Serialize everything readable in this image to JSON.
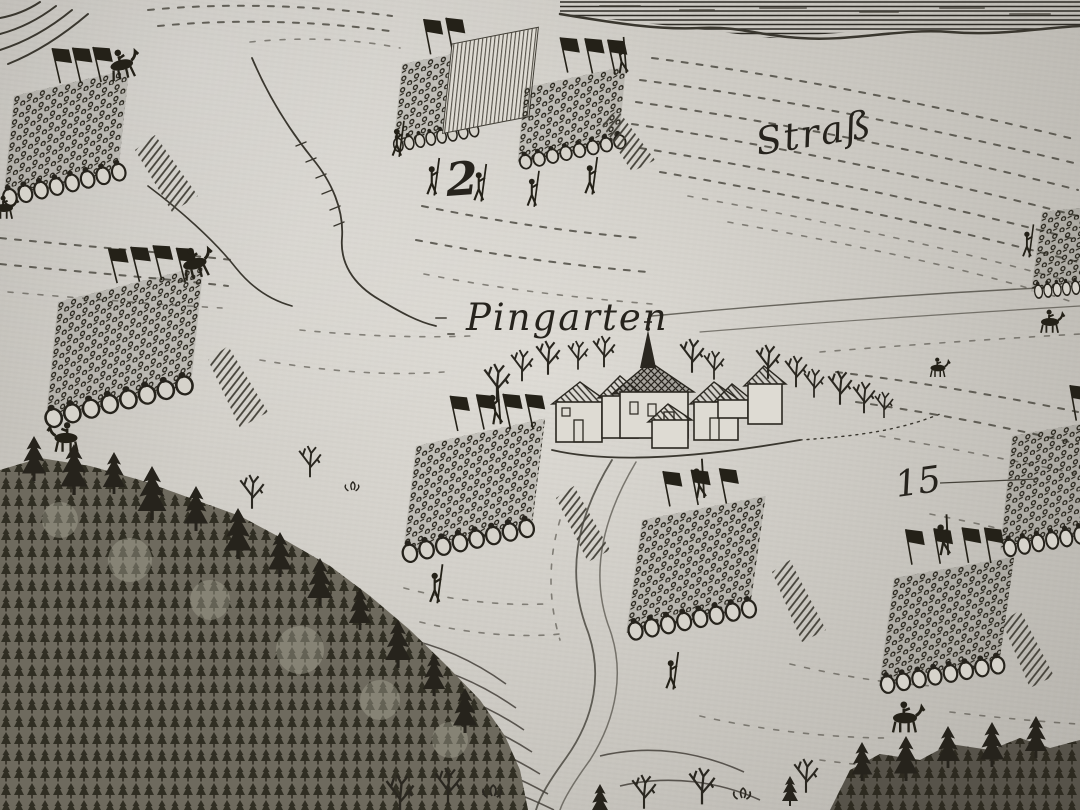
{
  "map": {
    "kind": "antique-engraved-battle-map-photo",
    "labels": {
      "road": "Straß",
      "village": "Pingarten",
      "formation_number": "2",
      "map_number": "15"
    },
    "colors": {
      "paper": "#d9d6cf",
      "paper_shadow": "#cecbc4",
      "ink": "#26231d",
      "ink_light": "#45423a"
    },
    "features": [
      {
        "id": "troop-block-top-left",
        "label": "infantry square, three flags, mounted officer"
      },
      {
        "id": "pike-square-2",
        "label": "pike square marked 2 with raised pikes and skirmishers"
      },
      {
        "id": "troop-block-mid-left",
        "label": "infantry square, flags, mounted officer, horseman below"
      },
      {
        "id": "troop-block-center",
        "label": "infantry square with four flags and standard bearer"
      },
      {
        "id": "troop-block-center-right",
        "label": "infantry square with three flags and standard bearer"
      },
      {
        "id": "troop-block-bottom-right",
        "label": "infantry square with four flags, horseman below"
      },
      {
        "id": "troop-block-right-edge",
        "label": "infantry square cropped at right edge"
      },
      {
        "id": "troop-block-top-right-edge",
        "label": "small troop ranks cropped at right edge"
      },
      {
        "id": "village-pingarten",
        "label": "village with church spire, houses, orchard trees, hedges"
      },
      {
        "id": "road-strass",
        "label": "road Straß along hatched river bank at top"
      },
      {
        "id": "stream",
        "label": "meandering stream with hatched gully"
      },
      {
        "id": "forest-bottom-left",
        "label": "dense conifer forest on hillside"
      },
      {
        "id": "field-furrows",
        "label": "dashed furrow lines of plowed fields"
      },
      {
        "id": "reference-number-15",
        "label": "engraved reference number with leader line"
      }
    ]
  }
}
